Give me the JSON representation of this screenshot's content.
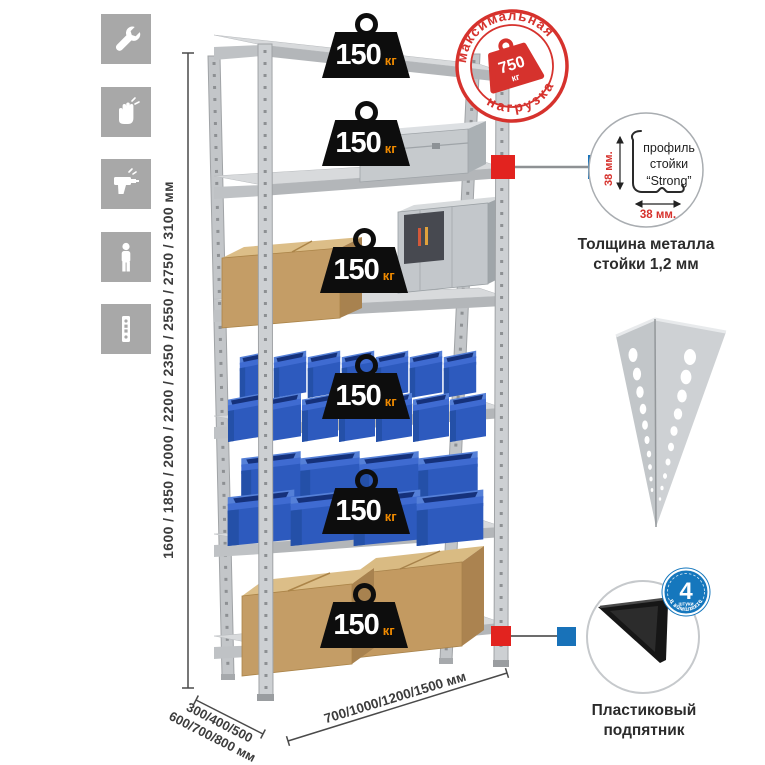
{
  "icons": [
    "wrench",
    "gloves",
    "drill",
    "person",
    "upright-post"
  ],
  "rack": {
    "shelf_count": 6,
    "shelf_loads": [
      {
        "value": "150",
        "unit": "кг"
      },
      {
        "value": "150",
        "unit": "кг"
      },
      {
        "value": "150",
        "unit": "кг"
      },
      {
        "value": "150",
        "unit": "кг"
      },
      {
        "value": "150",
        "unit": "кг"
      },
      {
        "value": "150",
        "unit": "кг"
      }
    ]
  },
  "max_load_stamp": {
    "arc_top": "максимальная",
    "arc_bottom": "нагрузка",
    "value": "750",
    "unit": "кг"
  },
  "dimensions": {
    "height_options": "1600 / 1850 / 2000 / 2200 / 2350 / 2550 / 2750 / 3100 мм",
    "depth_line1": "300/400/500",
    "depth_line2": "600/700/800 мм",
    "width_options": "700/1000/1200/1500 мм"
  },
  "profile_detail": {
    "label_line1": "профиль",
    "label_line2": "стойки",
    "label_line3": "“Strong”",
    "vertical_dim": "38 мм.",
    "horizontal_dim": "38 мм.",
    "caption_line1": "Толщина металла",
    "caption_line2": "стойки 1,2 мм"
  },
  "foot_detail": {
    "badge_value": "4",
    "badge_unit": "штуки",
    "badge_arc": "в комплекте",
    "caption_line1": "Пластиковый",
    "caption_line2": "подпятник"
  },
  "colors": {
    "stamp_red": "#d6322d",
    "marker_red": "#e2231f",
    "marker_blue": "#1872b9",
    "badge_blue": "#1577bd",
    "bin_blue": "#2d5abe",
    "weight_unit_orange": "#f08a00",
    "icon_tile_gray": "#a8a8a8"
  }
}
